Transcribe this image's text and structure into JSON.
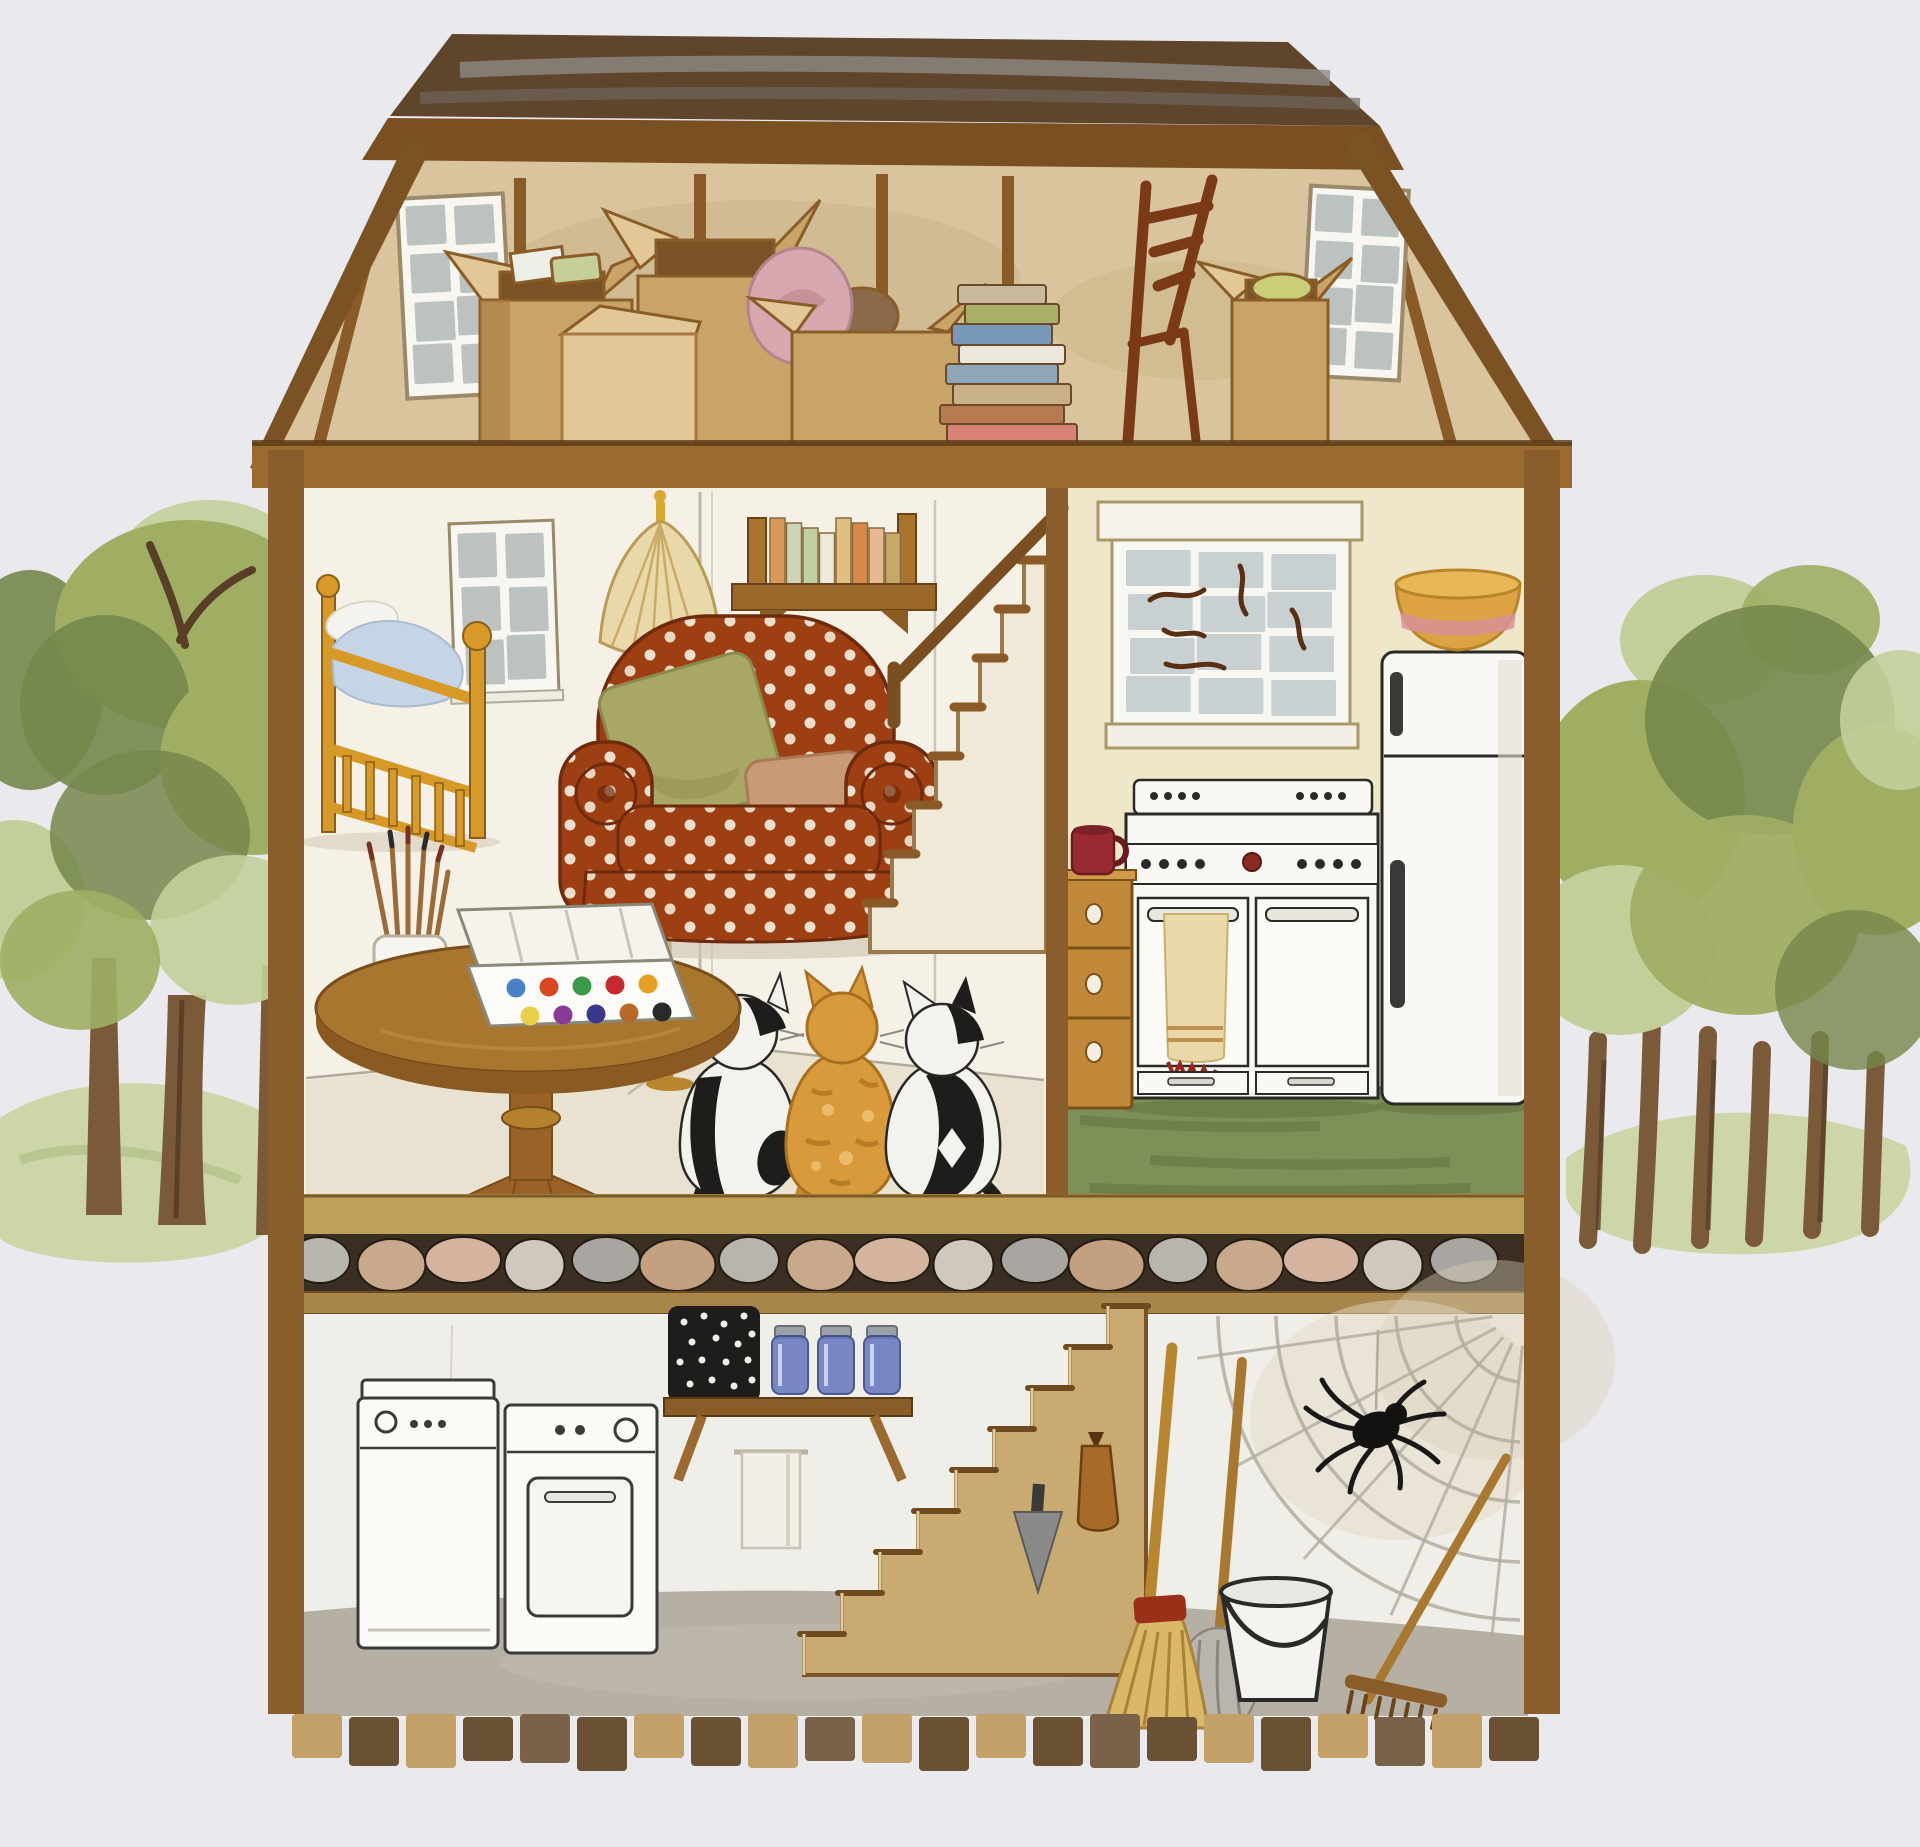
{
  "scene": {
    "type": "watercolor painting",
    "subject": "cutaway dollhouse interior showing attic, bedroom and living room, kitchen, stone foundation and basement, flanked by clusters of green trees",
    "rooms": [
      "attic",
      "bedroom-living-room",
      "kitchen",
      "basement"
    ]
  },
  "palette": {
    "bg": "#eae9ed",
    "outline": "#6a4a22",
    "roofDark": "#5e452c",
    "roofGray": "#8d8a84",
    "roofFascia": "#7a4f22",
    "atticWall": "#d9c49d",
    "atticWallShade": "#c3ab7e",
    "stud": "#8a5a28",
    "beam": "#9a6a30",
    "beamDark": "#5a3a16",
    "floorBand": "#bfa058",
    "creamWall": "#f5f1e6",
    "creamWallShade": "#e9e2d0",
    "kitchenWall": "#efe7ca",
    "kitchenFloor": "#7f8f58",
    "kitchenFloorDark": "#5f7040",
    "stoneBg": "#3a2f22",
    "stoneBeam": "#a8854a",
    "basementWall": "#f0eee8",
    "basementFloor": "#b6afa4",
    "brickLight": "#c2a068",
    "brickDark": "#6b5134",
    "woodGold": "#d79a28",
    "woodGoldDark": "#8a5e18",
    "woodMid": "#9a6226",
    "woodTable": "#a8762e",
    "woodTableDark": "#7a4e1a",
    "chairRust": "#9d3f12",
    "chairRustDark": "#6e2a0c",
    "pillowGreen": "#a9a766",
    "pillowGreenDark": "#8a8a4e",
    "pillowTan": "#c99a78",
    "applianceWhite": "#f9f8f4",
    "applianceLine": "#2a2a28",
    "paneBlue": "#c3ccce",
    "paneGray": "#b6bdbc",
    "windowFrame": "#f8f6f0",
    "branchBrown": "#5a3014",
    "jarBlue": "#6a7cc0",
    "jarLid": "#9aa0a8",
    "mugRed": "#9a2a32",
    "towelCream": "#ead9a8",
    "towelStripe": "#c09050",
    "towelFringe": "#9a2618",
    "bowlYellow": "#dda342",
    "bowlPink": "#d89098",
    "cardboard": "#c9a469",
    "cardboardDark": "#a87840",
    "cardboardLight": "#e2c896",
    "boxInterior": "#7a5226",
    "pinkVase": "#d8a8b0",
    "treeGreen": "#9fae63",
    "treeGreenDark": "#76874b",
    "treeGreenLight": "#c3cf9a",
    "grassGreen": "#ccd6a8",
    "trunkBrown": "#7b5a3a",
    "trunkDark": "#5a3f28",
    "catBlack": "#1f1d1c",
    "catWhite": "#f4f2ec",
    "catOrange": "#d99a3c",
    "catOrangeDark": "#a8701e",
    "glowYellow": "#e9c86a",
    "webGray": "#b3aba0",
    "bucketWhite": "#f4f3f0",
    "strawTan": "#d9b868",
    "strawDark": "#a8813a",
    "wrapRed": "#9a3018",
    "metalGray": "#8a8a88",
    "basketBlack": "#1f1d1b",
    "shadow": "#cfc6b2",
    "pencil": "#b0a898"
  },
  "attic": {
    "items": [
      "sloped-roof",
      "left-window",
      "right-window",
      "cardboard-boxes",
      "pink-vase",
      "book-stack",
      "ladder-back-chair",
      "open-box"
    ],
    "book_stack_colors": [
      "#c8b89c",
      "#a9b168",
      "#7a99b8",
      "#ebe7dd",
      "#8ea6b8",
      "#c8b088",
      "#b87a50",
      "#d88276"
    ]
  },
  "living_room": {
    "items": [
      "crib",
      "window",
      "floor-lamp",
      "wall-bookshelf",
      "polka-dot-armchair",
      "green-pillow",
      "tan-pillow",
      "staircase",
      "round-table",
      "paintbrush-cup",
      "watercolor-box",
      "three-cats"
    ],
    "shelf_book_colors": [
      "#d89858",
      "#cfd4b8",
      "#c2cf9e",
      "#efe9da",
      "#e0c080",
      "#d88848",
      "#e8b890",
      "#c8a868"
    ],
    "paint_colors": [
      "#4a80c8",
      "#d84820",
      "#3a9a48",
      "#c82830",
      "#e8a020",
      "#e8d048",
      "#8a3a98",
      "#38388a",
      "#b86828",
      "#2a2a2a"
    ],
    "staircase_steps": 8,
    "cats": [
      "tuxedo",
      "orange-tabby",
      "tuxedo"
    ]
  },
  "kitchen": {
    "items": [
      "window-with-branches",
      "mixing-bowl",
      "refrigerator",
      "stove",
      "hanging-towel",
      "wooden-drawer-cabinet",
      "red-mug",
      "green-floor"
    ]
  },
  "foundation": {
    "stone_colors": [
      "#b8b4ae",
      "#c9a98c",
      "#d4b49e",
      "#cfc9bd",
      "#a9a5a0",
      "#c2a080"
    ]
  },
  "basement": {
    "items": [
      "washer",
      "dryer",
      "wall-shelf",
      "speckled-basket",
      "blue-jars",
      "hand-towel",
      "staircase",
      "hanging-bag",
      "hanging-trowel",
      "broom",
      "mop",
      "bucket",
      "rake",
      "spider-web",
      "spider"
    ],
    "jar_count": 3,
    "staircase_steps": 9
  },
  "outdoors": {
    "items": [
      "left-tree-cluster",
      "right-tree-cluster",
      "grass-mounds"
    ]
  }
}
